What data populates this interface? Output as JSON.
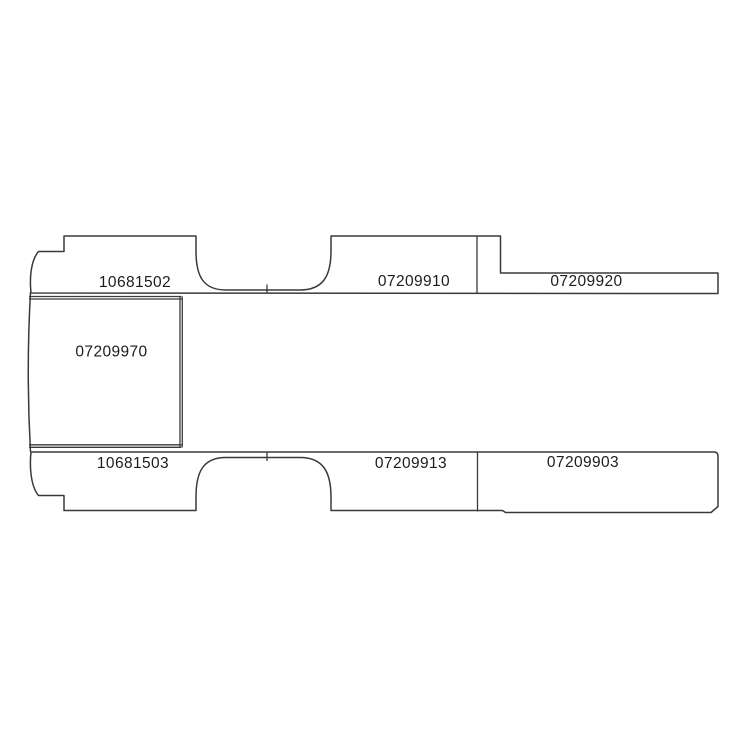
{
  "diagram": {
    "colors": {
      "background": "#ffffff",
      "line": "#3a3a3a",
      "text": "#1c1c1c"
    },
    "parts": {
      "top_left": "10681502",
      "top_middle": "07209910",
      "top_right": "07209920",
      "center": "07209970",
      "bottom_left": "10681503",
      "bottom_middle": "07209913",
      "bottom_right": "07209903"
    }
  }
}
